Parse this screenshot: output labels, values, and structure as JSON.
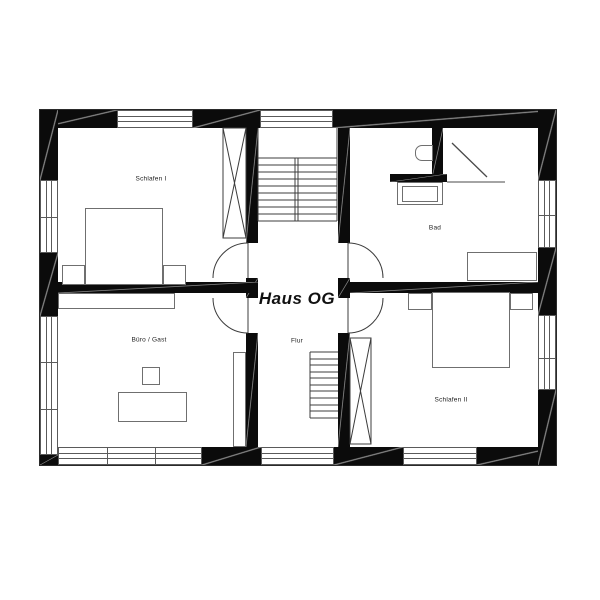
{
  "title": "Haus OG",
  "rooms": {
    "schlafen1": {
      "label": "Schlafen I"
    },
    "bad": {
      "label": "Bad"
    },
    "buero": {
      "label": "Büro / Gast"
    },
    "flur": {
      "label": "Flur"
    },
    "schlafen2": {
      "label": "Schlafen II"
    }
  },
  "colors": {
    "wall": "#0b0b0b",
    "thin_line": "#5a5a5a",
    "furniture_line": "#6f6f6f",
    "background": "#ffffff"
  }
}
